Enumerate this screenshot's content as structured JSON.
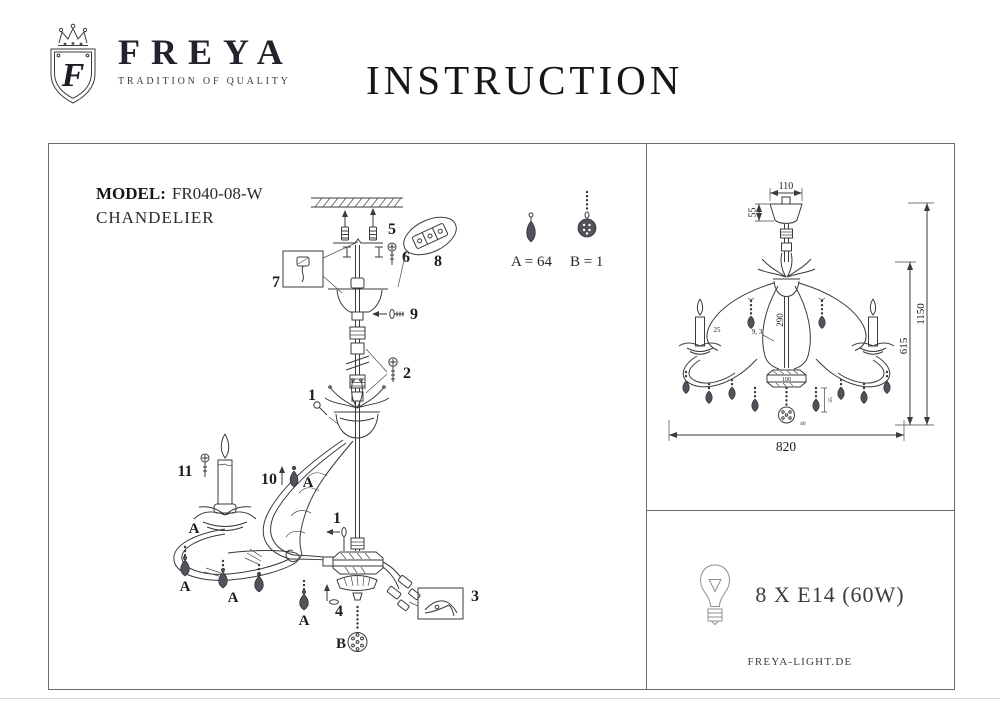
{
  "header": {
    "brand": "FREYA",
    "tagline": "TRADITION OF QUALITY",
    "logo_letter": "F",
    "title": "INSTRUCTION"
  },
  "model": {
    "label": "MODEL:",
    "value": "FR040-08-W",
    "type": "CHANDELIER"
  },
  "exploded": {
    "parts": [
      "1",
      "2",
      "3",
      "4",
      "5",
      "6",
      "7",
      "8",
      "9",
      "10",
      "11"
    ],
    "letterA": "A",
    "letterB": "B"
  },
  "counts": {
    "a": "A = 64",
    "b": "B = 1"
  },
  "dims": {
    "canopy_width": "110",
    "canopy_height": "55",
    "stem_drop": "290",
    "arm_note": "9, 3",
    "candle_note": "25",
    "hub_width": "100",
    "body_height": "615",
    "total_height": "1150",
    "total_width": "820",
    "ball_size": "40",
    "pendant_drop": "35"
  },
  "spec": {
    "bulbs": "8 X E14 (60W)",
    "website": "FREYA-LIGHT.DE"
  },
  "icons": {
    "logo": "freya-crown-shield-icon",
    "bulb": "light-bulb-icon",
    "crystal_a": "teardrop-crystal-icon",
    "crystal_b": "chain-ball-crystal-icon"
  }
}
